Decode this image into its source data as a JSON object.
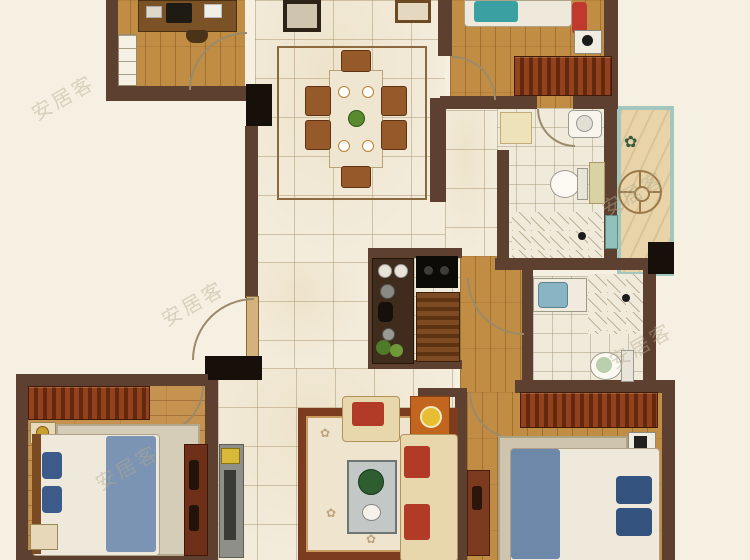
{
  "watermark": {
    "text": "安居客"
  },
  "palette": {
    "outside_background": "#f6f0e2",
    "wall": "#5d4030",
    "structural_column": "#17100a",
    "wood_floor": "#c18d44",
    "tile_floor": "#f3ecdb",
    "bathroom_tile": "#f0eadb",
    "balcony_floor": "#e8d4a8",
    "balcony_glass": "#a3c6bf",
    "wardrobe_red": "#93421d",
    "bed_blanket_blue": "#7b94b4",
    "pillow_blue": "#3c5a8a",
    "teal_pillow": "#3aa0a2",
    "sofa_cream": "#e8d6ac",
    "cushion_red": "#b23b28",
    "side_table_orange": "#c2661f",
    "rug_border": "#7c3c1f"
  },
  "rooms": [
    {
      "name": "study",
      "furniture": [
        "desk",
        "computer-monitor",
        "desk-chair",
        "bookshelf",
        "door"
      ]
    },
    {
      "name": "dining-room",
      "furniture": [
        "dining-table",
        "chairs-x6",
        "area-rug",
        "sideboard",
        "console-table"
      ]
    },
    {
      "name": "kitchen",
      "furniture": [
        "counter",
        "sink",
        "cooktop",
        "slatted-cabinet",
        "plant"
      ]
    },
    {
      "name": "bedroom-top-right",
      "furniture": [
        "double-bed",
        "wardrobe",
        "nightstand",
        "door"
      ]
    },
    {
      "name": "bathroom-main",
      "furniture": [
        "washbasin",
        "toilet",
        "shower-area",
        "vanity-cabinet",
        "balcony-door"
      ]
    },
    {
      "name": "laundry-balcony",
      "furniture": [
        "round-table",
        "plant",
        "storage-box"
      ]
    },
    {
      "name": "bathroom-second",
      "furniture": [
        "washbasin",
        "toilet",
        "shower-area"
      ]
    },
    {
      "name": "bedroom-bottom-left",
      "furniture": [
        "double-bed",
        "wardrobe",
        "nightstand-x2",
        "dresser",
        "area-rug",
        "door"
      ]
    },
    {
      "name": "living-room",
      "furniture": [
        "sofa",
        "armchair",
        "coffee-table",
        "tv-console",
        "side-table-with-lamp",
        "area-rug"
      ]
    },
    {
      "name": "bedroom-bottom-right",
      "furniture": [
        "double-bed",
        "wardrobe",
        "nightstand",
        "dresser",
        "area-rug",
        "door"
      ]
    },
    {
      "name": "entry-hall",
      "furniture": [
        "entry-door"
      ]
    }
  ]
}
